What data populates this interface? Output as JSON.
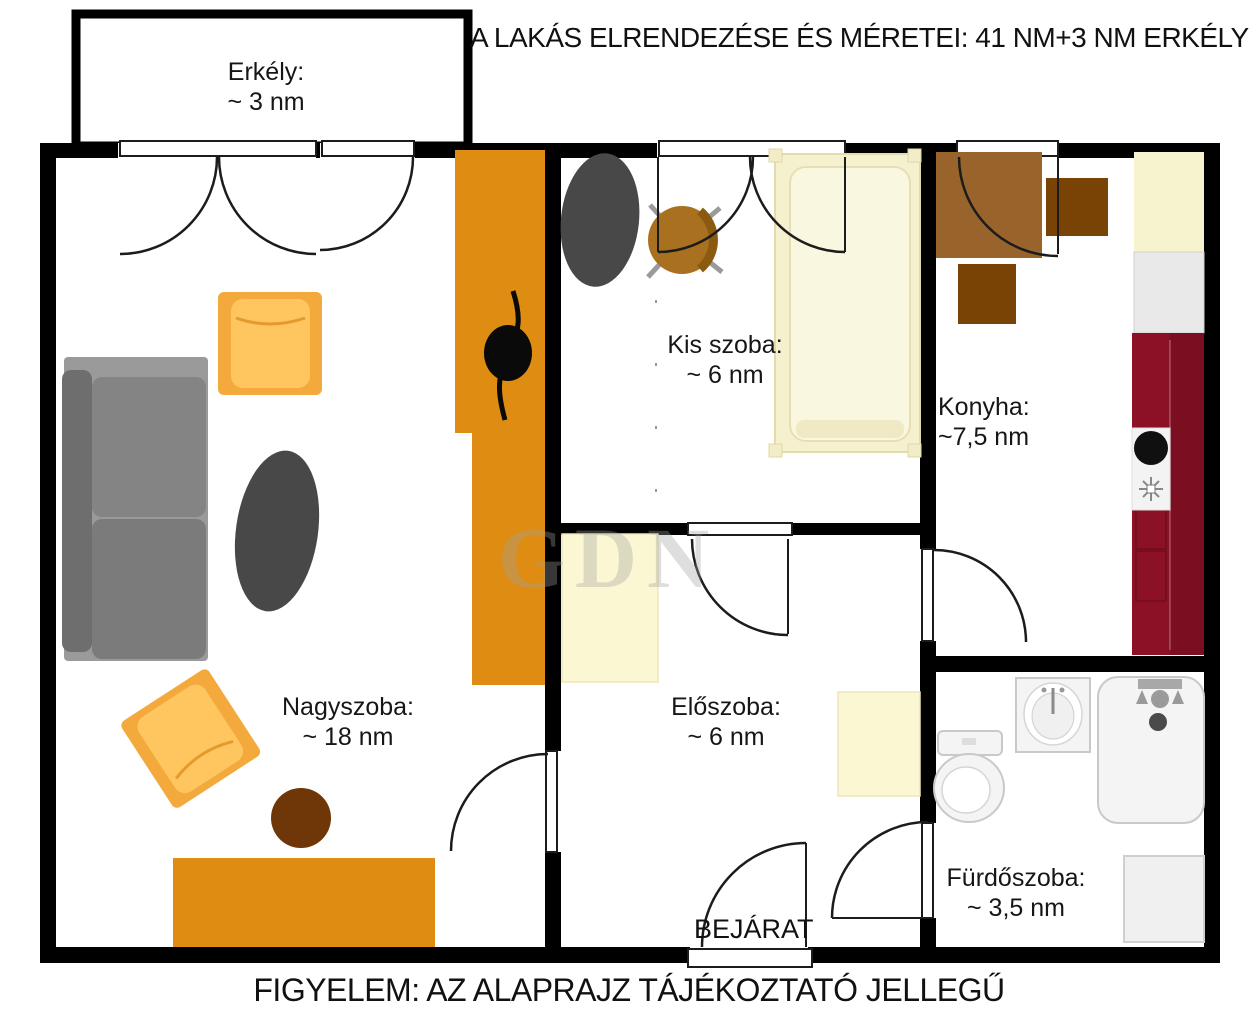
{
  "title": "A LAKÁS ELRENDEZÉSE ÉS MÉRETEI: 41 NM+3 NM ERKÉLY",
  "footer": {
    "notice": "FIGYELEM: AZ ALAPRAJZ TÁJÉKOZTATÓ JELLEGŰ"
  },
  "entrance": {
    "label": "BEJÁRAT"
  },
  "watermark": "GDN",
  "rooms": {
    "balcony": {
      "name": "Erkély:",
      "area": "~ 3 nm"
    },
    "living": {
      "name": "Nagyszoba:",
      "area": "~ 18 nm"
    },
    "small": {
      "name": "Kis szoba:",
      "area": "~ 6 nm"
    },
    "kitchen": {
      "name": "Konyha:",
      "area": "~7,5 nm"
    },
    "hall": {
      "name": "Előszoba:",
      "area": "~ 6 nm"
    },
    "bathroom": {
      "name": "Fürdőszoba:",
      "area": "~ 3,5 nm"
    }
  },
  "totals": {
    "apartment": "41 NM",
    "balcony": "3 NM"
  },
  "colors": {
    "wall": "#000000",
    "wardrobe_orange": "#DE8C12",
    "armchair_amber": "#F3A93C",
    "armchair_cushion": "#FFC55E",
    "sofa_gray": "#828282",
    "rug_dark": "#484848",
    "wood_brown": "#99642C",
    "chair_dark_brown": "#7A4306",
    "stool_brown": "#6F3608",
    "counter_red": "#8C1126",
    "cream": "#F7F3CE",
    "fixture_white": "#F4F4F4"
  }
}
